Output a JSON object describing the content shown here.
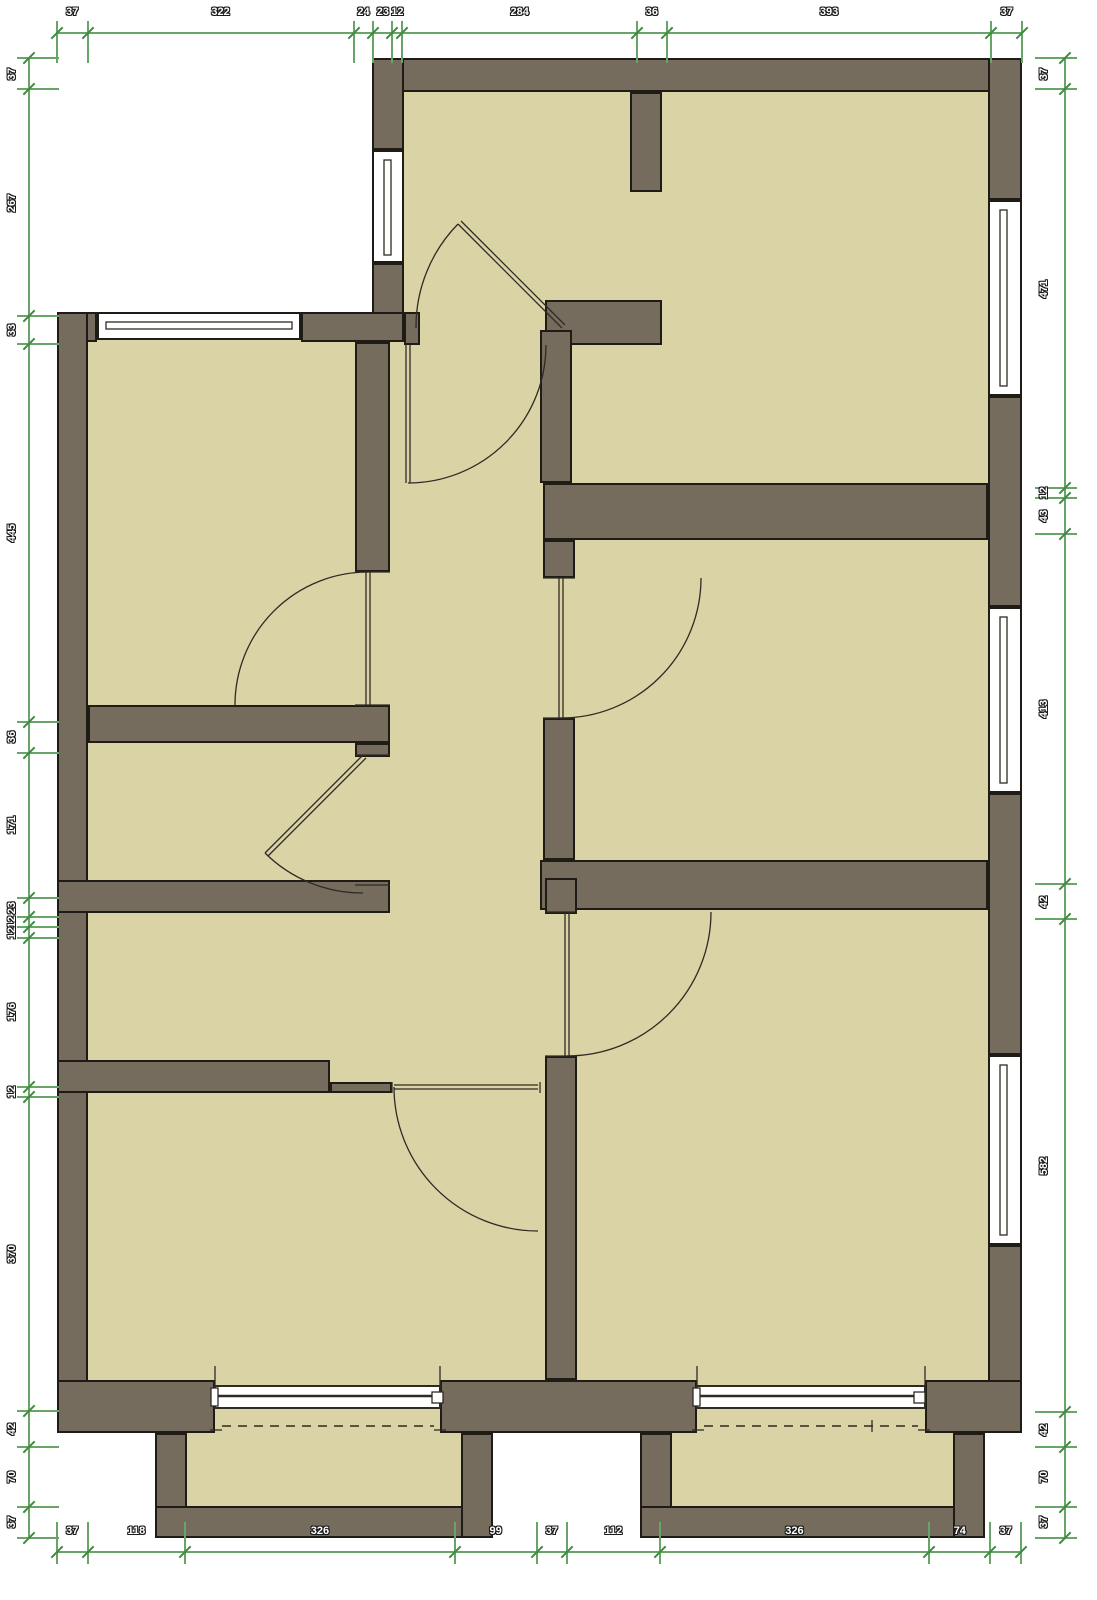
{
  "palette": {
    "wall": "#756c5d",
    "room": "#d9d3a6",
    "outline": "#1f1c15",
    "dimension_line": "#69a469",
    "dimension_tick": "#3d8b3d",
    "dimension_text": "#ffffff",
    "background": "#ffffff",
    "thin_line": "#2e2b24"
  },
  "dimensions": {
    "top": [
      37,
      322,
      24,
      23,
      12,
      284,
      36,
      393,
      37
    ],
    "bottom": [
      37,
      118,
      326,
      99,
      37,
      112,
      326,
      74,
      37
    ],
    "left": [
      37,
      267,
      33,
      445,
      36,
      171,
      23,
      12,
      12,
      176,
      12,
      370,
      42,
      70,
      37
    ],
    "right": [
      37,
      471,
      12,
      43,
      413,
      42,
      582,
      42,
      70,
      37
    ]
  }
}
